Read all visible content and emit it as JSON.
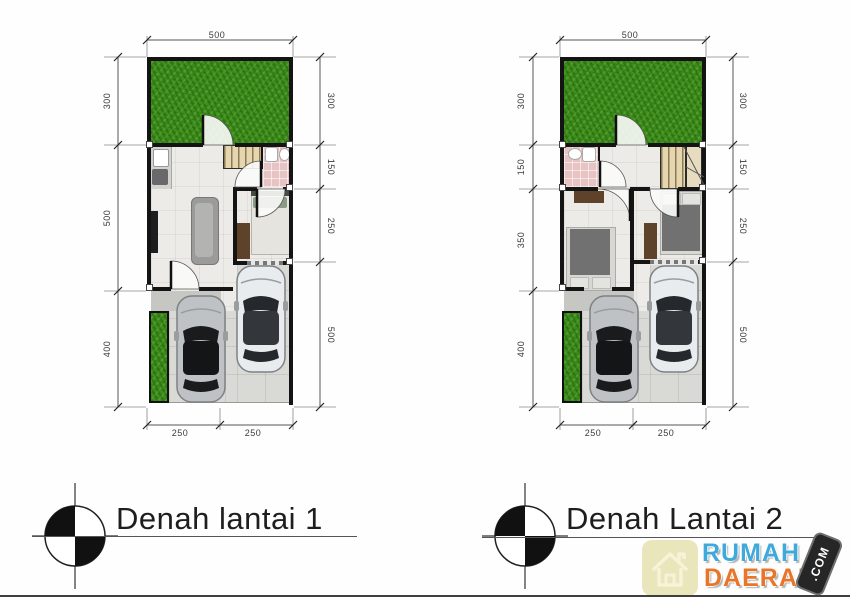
{
  "plans": [
    {
      "title": "Denah lantai 1",
      "dims": {
        "top": [
          "500"
        ],
        "left": [
          "300",
          "500",
          "400"
        ],
        "right": [
          "300",
          "150",
          "250",
          "500"
        ],
        "bottom": [
          "250",
          "250"
        ]
      }
    },
    {
      "title": "Denah Lantai 2",
      "dims": {
        "top": [
          "500"
        ],
        "left": [
          "300",
          "150",
          "350",
          "400"
        ],
        "right": [
          "300",
          "150",
          "250",
          "500"
        ],
        "bottom": [
          "250",
          "250"
        ]
      }
    }
  ],
  "watermark": {
    "line1": "RUMAH",
    "line2": "DAERAH",
    "badge": ".COM"
  },
  "colors": {
    "grass_green": "#3e8e1d",
    "wall_black": "#141414",
    "bathroom_pink": "#e7c3c3",
    "stair_tan": "#e6d6b0",
    "watermark_blue": "#3fa9dc",
    "watermark_orange": "#e8762a",
    "badge_black": "#262626"
  }
}
